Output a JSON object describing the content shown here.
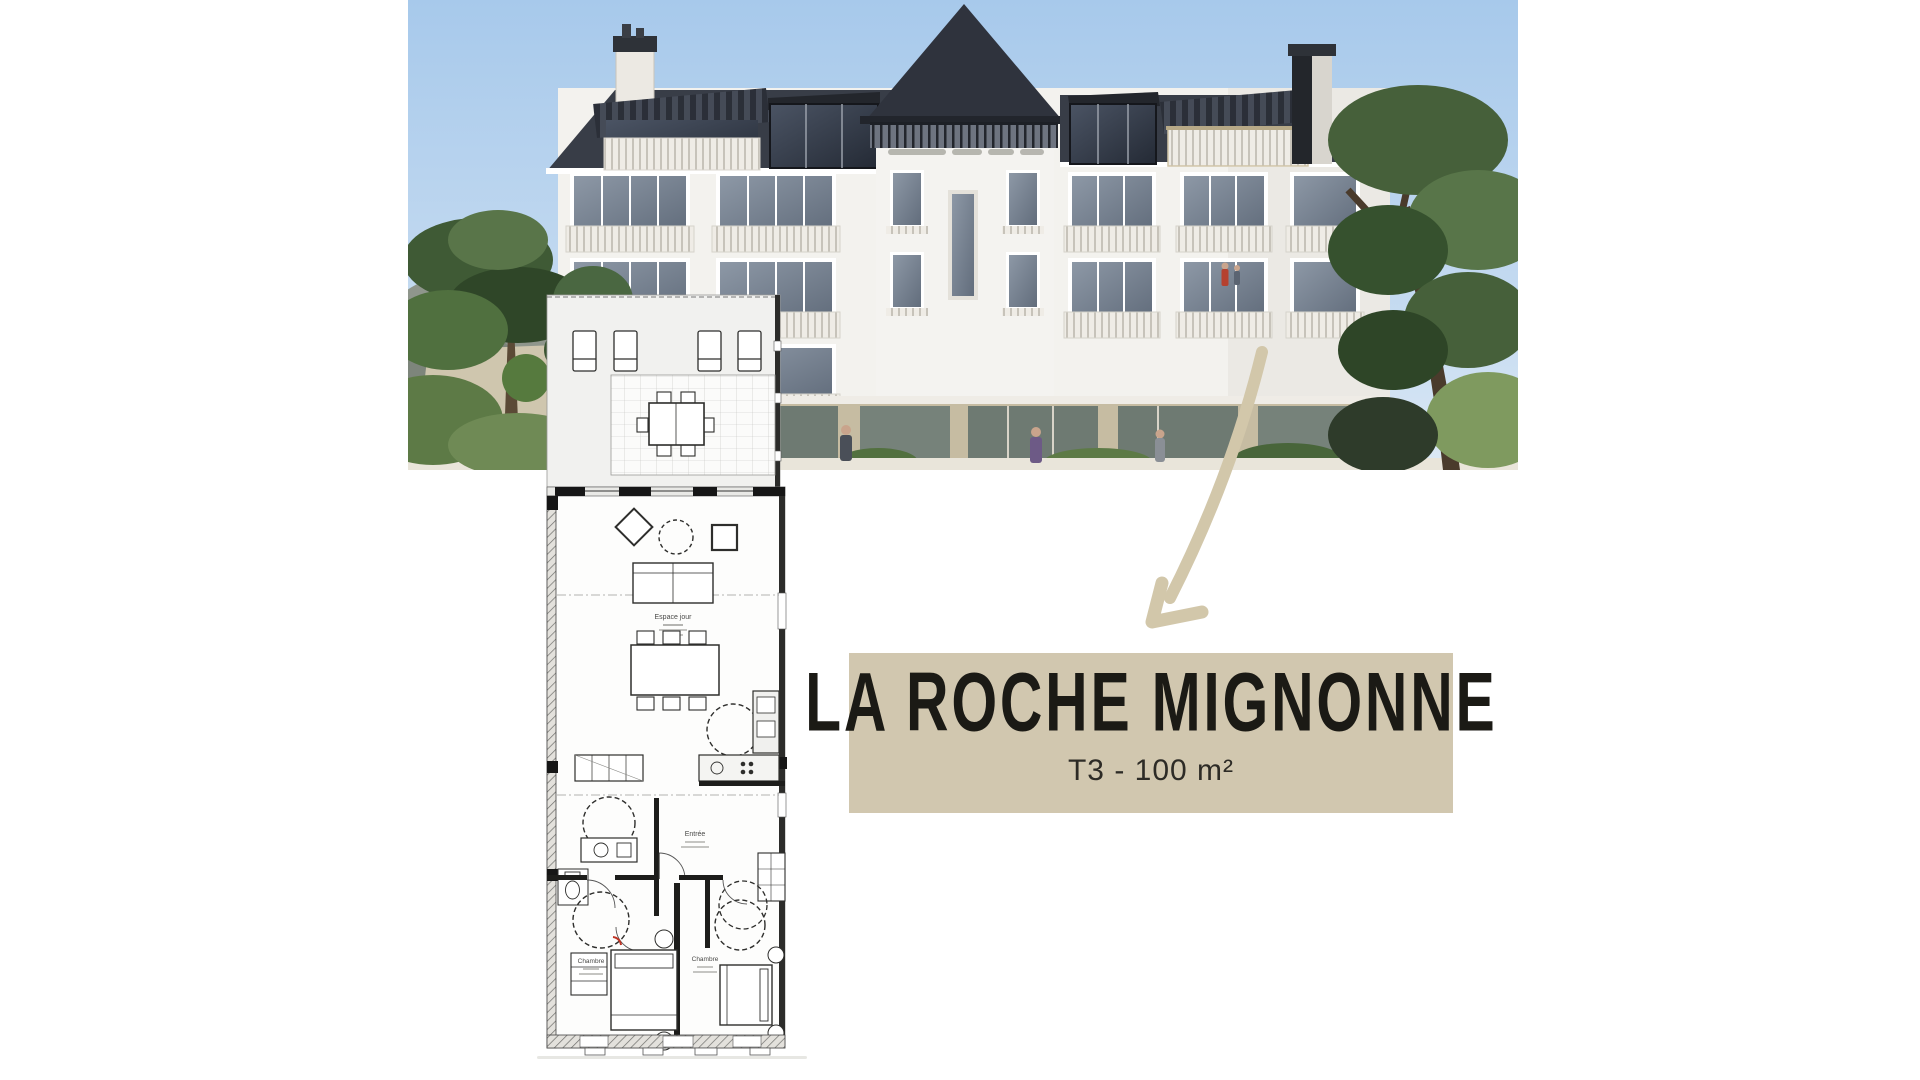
{
  "banner": {
    "title": "LA ROCHE MIGNONNE",
    "subtitle": "T3 - 100 m²",
    "background": "#d1c7af",
    "title_color": "#1b1a15",
    "subtitle_color": "#2d2b26"
  },
  "floor_plan": {
    "labels": {
      "living_area": "Espace jour",
      "entrance": "Entrée",
      "bedroom_1": "Chambre",
      "bedroom_2": "Chambre"
    },
    "line_color": "#2e2e2c",
    "paper_color": "#fdfdfc"
  },
  "annotation_arrow": {
    "color": "#d2c7aa"
  },
  "building_photo": {
    "sky_top": "#a7c9eb",
    "sky_bottom": "#dce9f5",
    "roof_color": "#383d47",
    "facade_color": "#f3f2ee",
    "stone_color": "#c6bca2",
    "tree_dark": "#3f5a35",
    "tree_mid": "#597549",
    "tree_light": "#7f9a5f"
  }
}
